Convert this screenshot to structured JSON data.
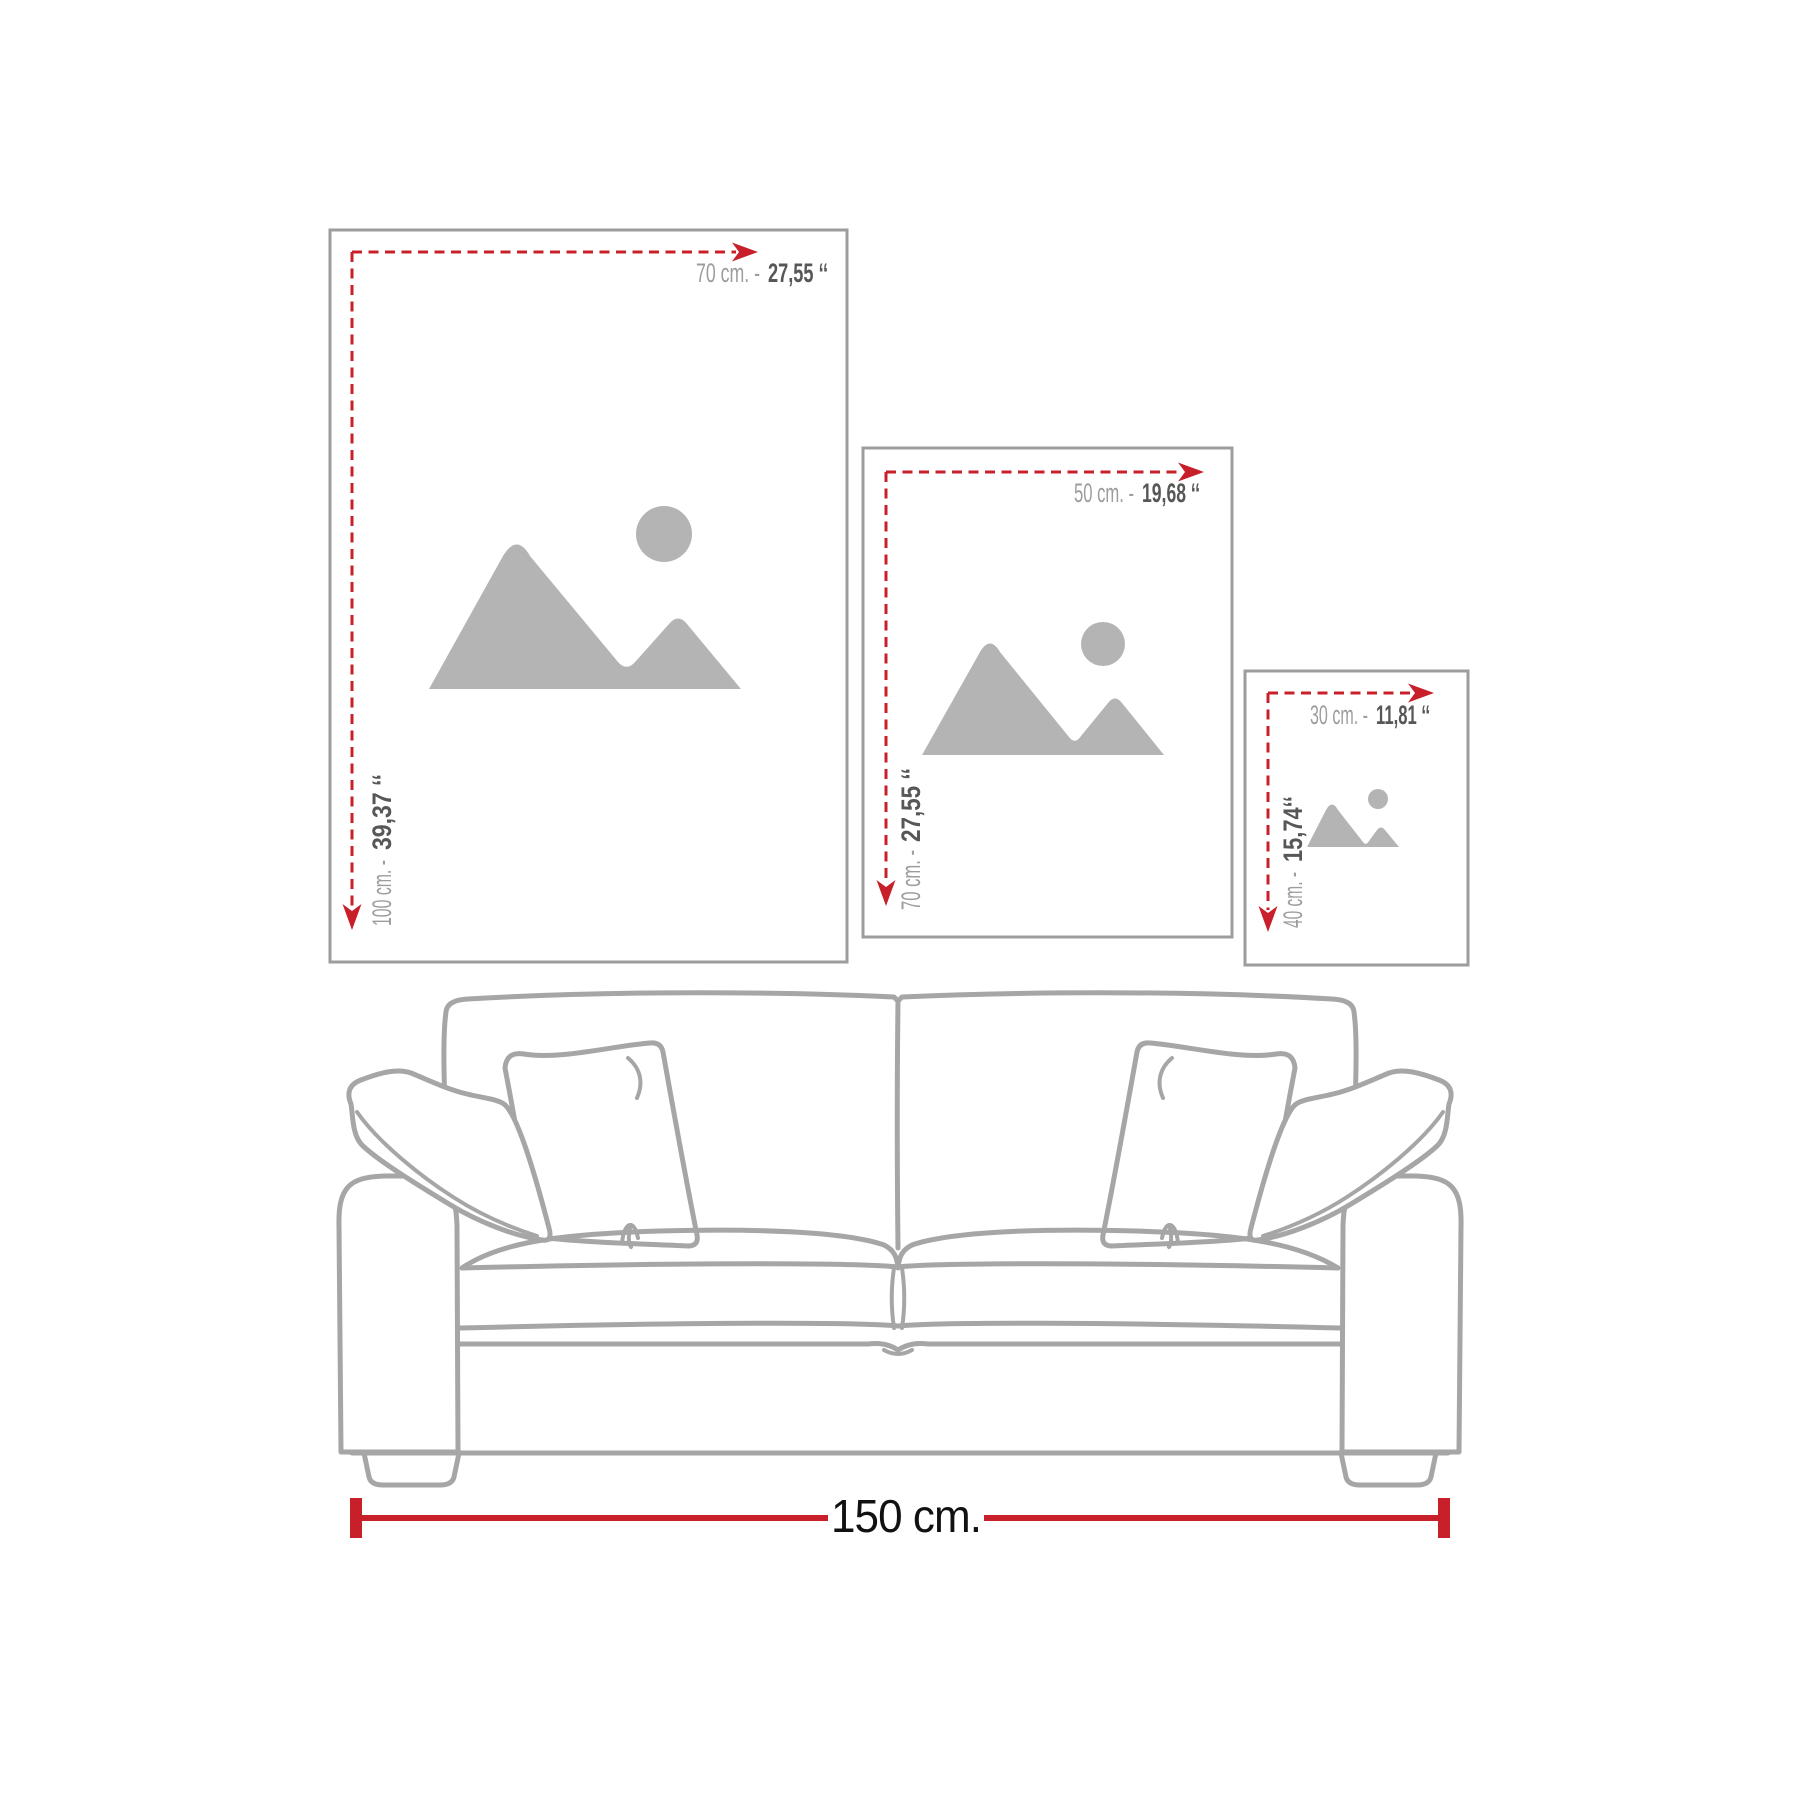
{
  "frames": [
    {
      "id": "large",
      "width_cm": "70 cm. -",
      "width_in": "27,55 ‘‘",
      "height_cm": "100 cm. -",
      "height_in": "39,37 ‘‘"
    },
    {
      "id": "medium",
      "width_cm": "50 cm. -",
      "width_in": "19,68 ‘‘",
      "height_cm": "70 cm. -",
      "height_in": "27,55 ‘‘"
    },
    {
      "id": "small",
      "width_cm": "30 cm. -",
      "width_in": "11,81 ‘‘",
      "height_cm": "40 cm. -",
      "height_in": "15,74‘‘"
    }
  ],
  "sofa": {
    "width_label": "150 cm."
  },
  "colors": {
    "accent_red": "#c8202b",
    "label_gray": "#9d9d9c",
    "label_dark": "#575756",
    "frame_border": "#9d9d9c",
    "placeholder_gray": "#b4b4b4",
    "sofa_line_gray": "#a6a6a6",
    "measure_text": "#111111"
  }
}
